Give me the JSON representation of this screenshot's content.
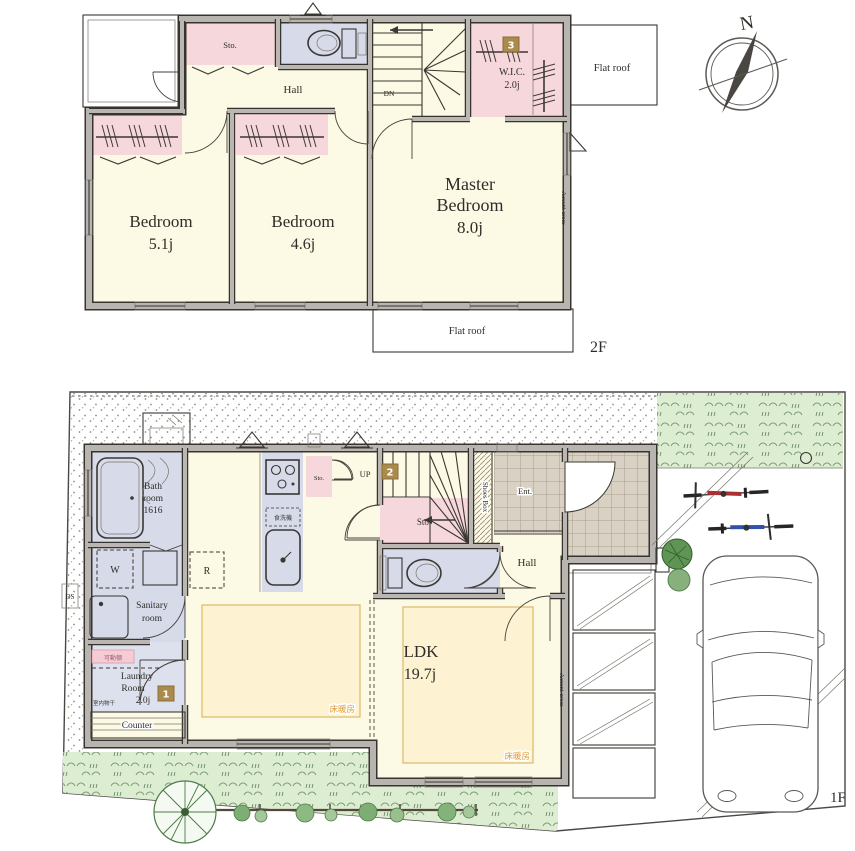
{
  "palette": {
    "wall_gray": "#b8b5b0",
    "room_cream": "#fcf9e4",
    "closet_pink": "#f6d7dc",
    "wet_blue": "#d6dae9",
    "heating_yellow": "#fdf3d2",
    "heating_text": "#dd9b35",
    "grass_green": "#dcedd2",
    "tile_beige": "#d9d1c3",
    "badge_gold": "#ab8b4c"
  },
  "floor2": {
    "floor_label": "2F",
    "compass_label": "N",
    "rooms": {
      "sto": "Sto.",
      "hall": "Hall",
      "dn": "DN",
      "wic": {
        "name": "W.I.C.",
        "area": "2.0j",
        "badge": "3"
      },
      "flat_roof_right": "Flat roof",
      "flat_roof_bottom": "Flat roof",
      "bedroom1": {
        "name": "Bedroom",
        "area": "5.1j"
      },
      "bedroom2": {
        "name": "Bedroom",
        "area": "4.6j"
      },
      "master": {
        "name1": "Master",
        "name2": "Bedroom",
        "area": "8.0j"
      },
      "accent_cross": "Accent cross"
    }
  },
  "floor1": {
    "floor_label": "1F",
    "rooms": {
      "bathroom": {
        "line1": "Bath",
        "line2": "room",
        "line3": "1616"
      },
      "washer": "W",
      "fridge": "R",
      "sanitary": {
        "line1": "Sanitary",
        "line2": "room"
      },
      "movable_shelf": "可動棚",
      "indoor_drying": "室内物干",
      "laundry": {
        "line1": "Laundry",
        "line2": "Room",
        "line3": "2.0j",
        "badge": "1"
      },
      "counter": "Counter",
      "dishwasher": "食洗機",
      "sto_kitchen": "Sto.",
      "up": "UP",
      "up_badge": "2",
      "sto_stairs": "Sto.",
      "shoes_box": "Shoes Box",
      "entrance": "Ent.",
      "hall": "Hall",
      "ldk": {
        "name": "LDK",
        "area": "19.7j"
      },
      "floor_heating_left": "床暖房",
      "floor_heating_right": "床暖房",
      "accent_cross": "Accent cross",
      "ds": "DS"
    }
  }
}
